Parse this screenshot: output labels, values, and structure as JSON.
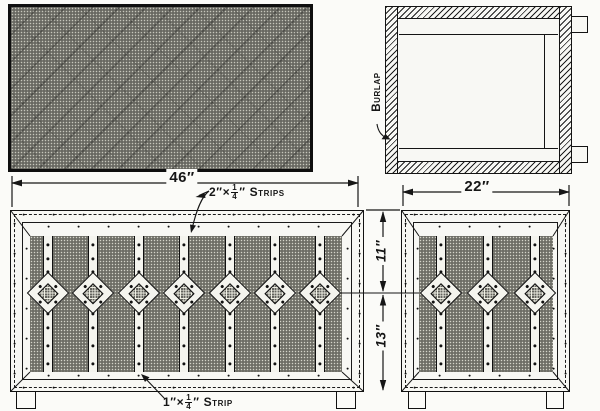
{
  "drawing": {
    "labels": {
      "burlap": "Burlap",
      "strips_2x": {
        "pre": "2″×",
        "num": "1",
        "den": "4",
        "post": "″ Strips"
      },
      "strip_1x": {
        "pre": "1″×",
        "num": "1",
        "den": "4",
        "post": "″ Strip"
      }
    },
    "dimensions": {
      "overall_width": "46″",
      "side_width": "22″",
      "upper_height": "11″",
      "lower_height": "13″"
    },
    "panels": {
      "front": {
        "strip_count": 7,
        "diamond_count": 7
      },
      "side": {
        "strip_count": 3,
        "diamond_count": 3
      }
    },
    "colors": {
      "ink": "#161616",
      "paper": "#fbfbf8",
      "burlap": "#44443f"
    }
  }
}
